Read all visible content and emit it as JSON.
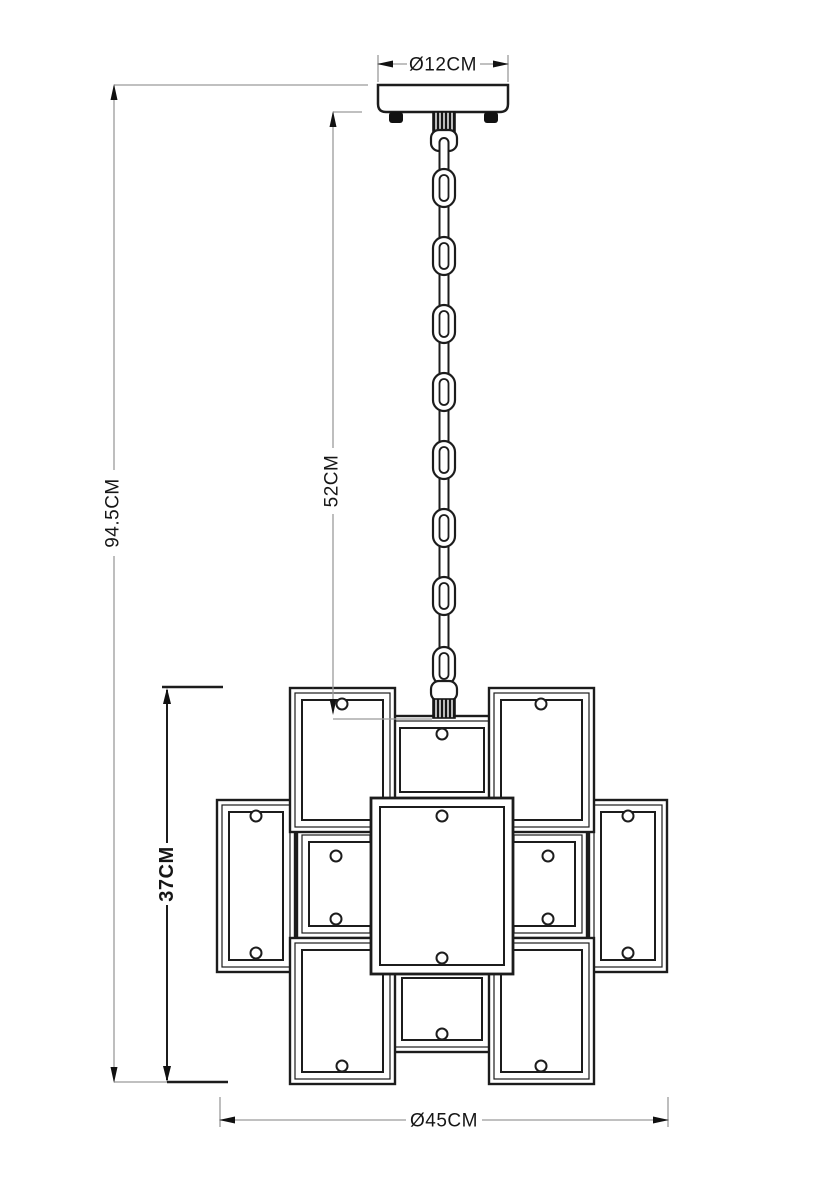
{
  "drawing": {
    "title": "pendant lamp dimension drawing",
    "labels": {
      "canopy_diameter": "Ø12CM",
      "total_height": "94.5CM",
      "chain_length": "52CM",
      "body_height": "37CM",
      "body_diameter": "Ø45CM"
    },
    "chain_link_count": 8,
    "colors": {
      "background": "#ffffff",
      "line": "#1c1c1c",
      "dim_line": "#9b9b9b",
      "arrow": "#111111"
    }
  }
}
